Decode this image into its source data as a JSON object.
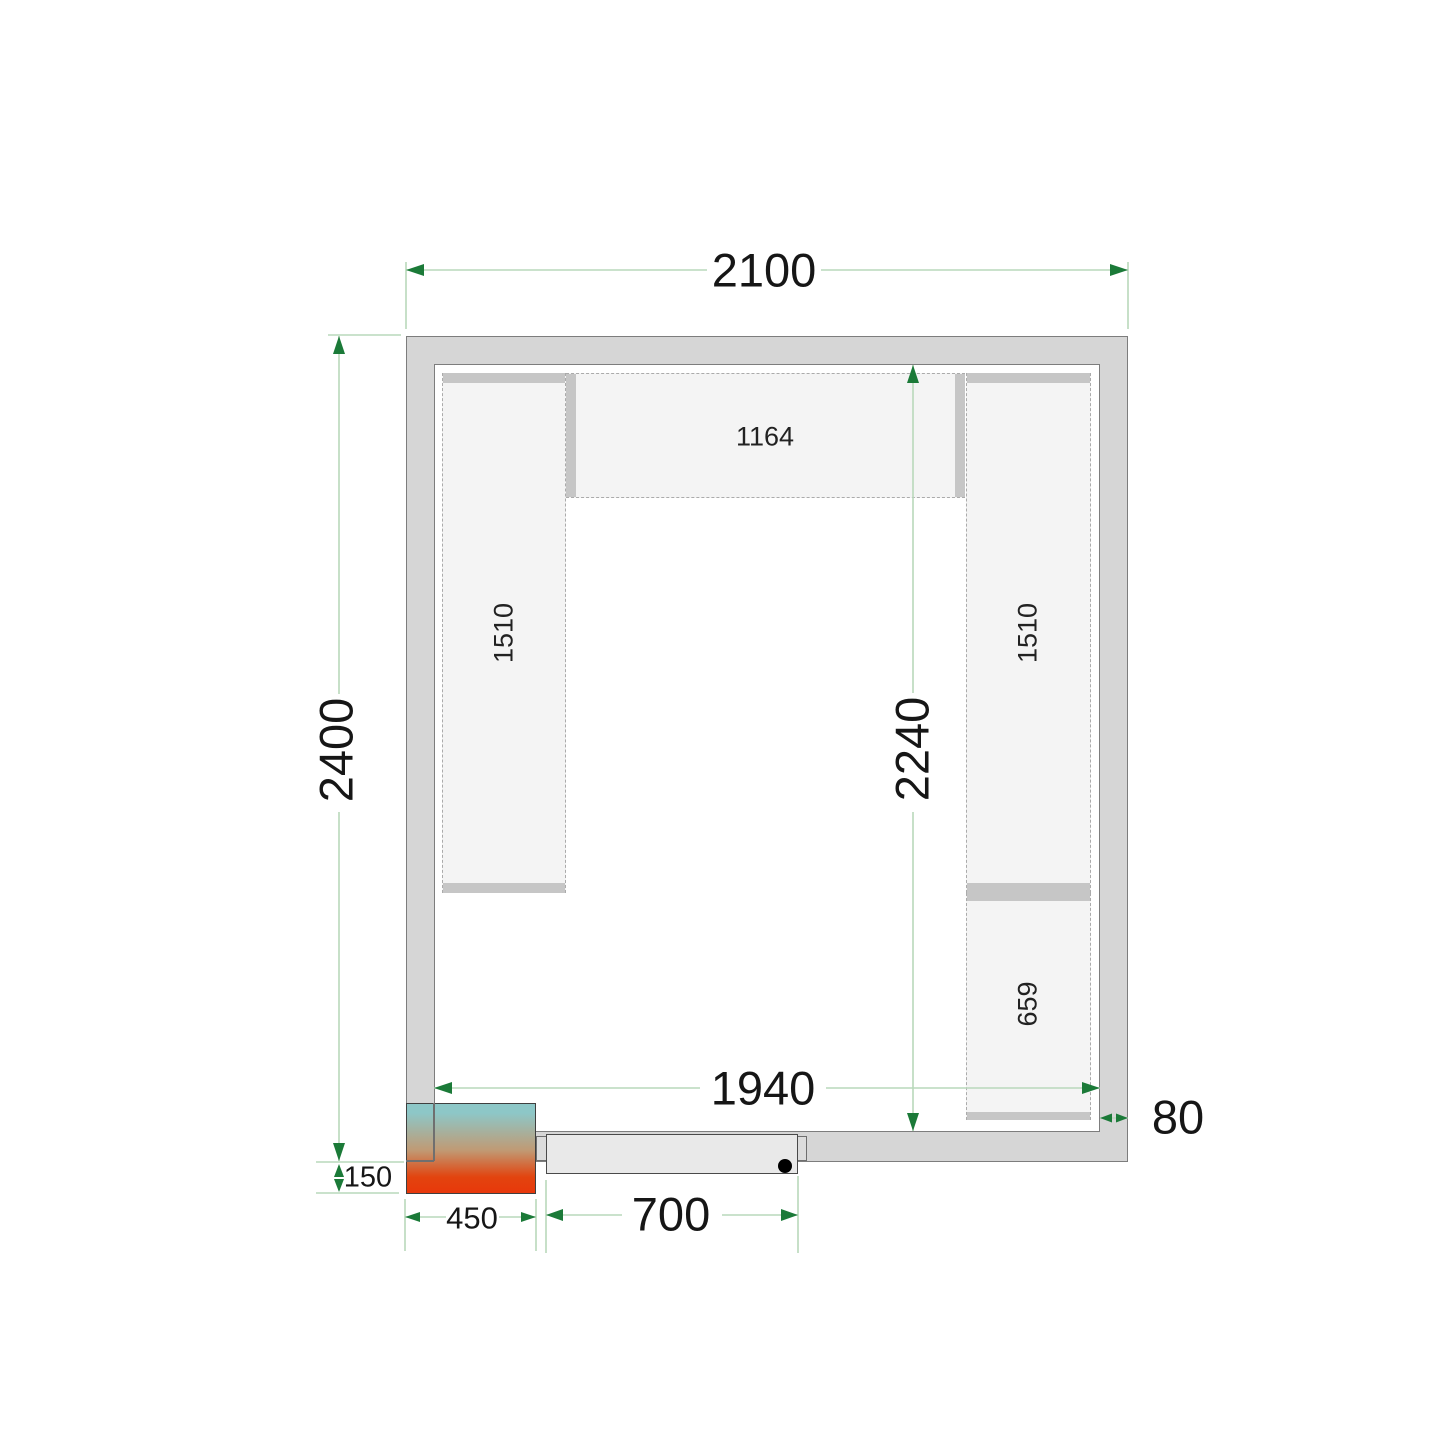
{
  "title": "Cold room floor plan - top view",
  "dims": {
    "outer_width": "2100",
    "outer_depth": "2400",
    "inner_width": "1940",
    "inner_depth": "2240",
    "wall_thickness": "80",
    "door_width": "700",
    "unit_width": "450",
    "unit_protrusion": "150"
  },
  "shelves": {
    "top": "1164",
    "left": "1510",
    "right": "1510",
    "right_bottom": "659"
  },
  "colors": {
    "dim_line": "#b9d8bb",
    "dim_arrow": "#1b7a38",
    "wall_fill": "#d6d6d6",
    "wall_edge": "#7d7d7d",
    "shelf_fill": "#f4f4f4",
    "shelf_dash": "#ababab",
    "shelf_end_bar": "#c6c6c6",
    "unit_gradient_top": "#8dc7c7",
    "unit_gradient_mid": "#c09a74",
    "unit_gradient_bottom": "#e8380b",
    "door_fill": "#e9e9e9",
    "door_handle": "#000000"
  }
}
